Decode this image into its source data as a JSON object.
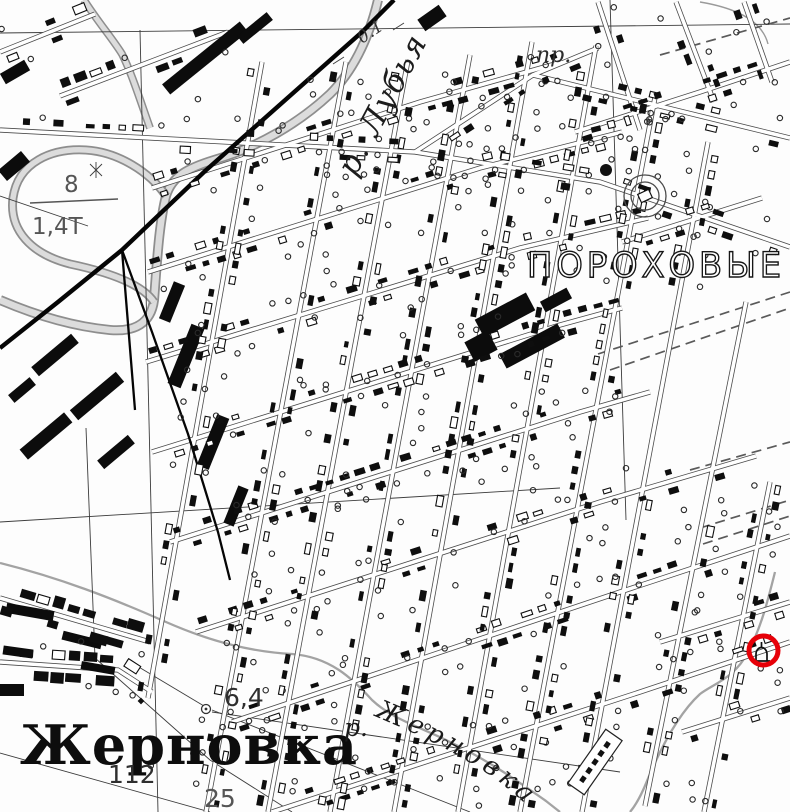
{
  "map": {
    "background": "#fdfdfd",
    "labels": {
      "district": "ПОРОХОВЫЕ",
      "village": "Жерновка",
      "river_top": "р. Лубья",
      "river_bottom_prefix": "р.",
      "river_bottom": "Жерновка",
      "prospect_abbr": "пр."
    },
    "numbers": {
      "road_note": "0.1",
      "bridge_width": "8",
      "bridge_load": "1,4Т",
      "spot_height": "6,4",
      "benchmark": "112",
      "mark": "25"
    },
    "annotation": {
      "color": "#e60008"
    }
  }
}
